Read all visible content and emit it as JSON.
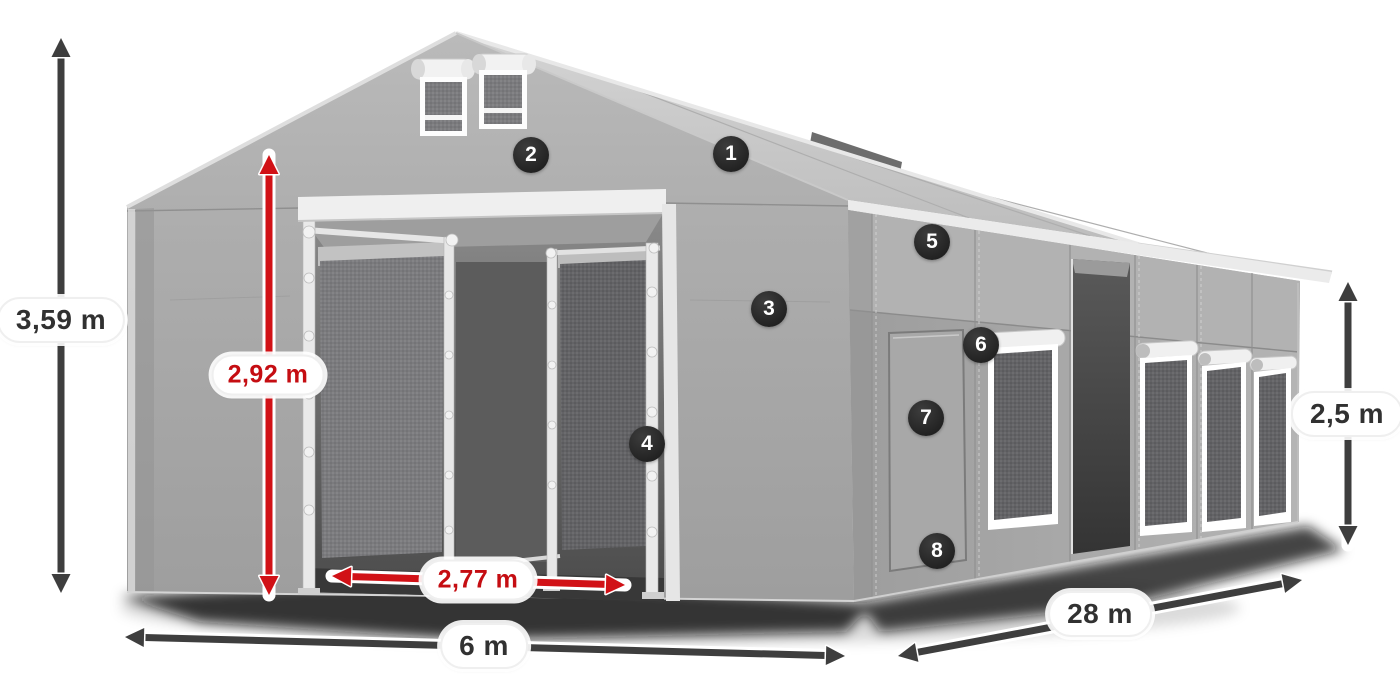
{
  "diagram": {
    "name": "tent-hall-dimensions-diagram",
    "background": "#ffffff"
  },
  "style": {
    "arrow_dark": "#3e3e3e",
    "arrow_red": "#d11116",
    "arrow_casing": "#ffffff",
    "marker_bg": "#2a2a2a",
    "marker_text": "#ffffff",
    "label_bg": "#ffffff",
    "label_border": "#efefef",
    "label_text_dark": "#313131",
    "label_text_red": "#c50d12",
    "tent_roof": "#c9c9c9",
    "tent_front": "#a9a9a9",
    "tent_side": "#a3a3a3",
    "tent_trim": "#ebebeb",
    "interior_dark": "#4f4f4f"
  },
  "markers": [
    {
      "number": "1",
      "x": 731,
      "y": 154
    },
    {
      "number": "2",
      "x": 531,
      "y": 155
    },
    {
      "number": "3",
      "x": 769,
      "y": 309
    },
    {
      "number": "4",
      "x": 647,
      "y": 444
    },
    {
      "number": "5",
      "x": 932,
      "y": 242
    },
    {
      "number": "6",
      "x": 981,
      "y": 345
    },
    {
      "number": "7",
      "x": 926,
      "y": 418
    },
    {
      "number": "8",
      "x": 937,
      "y": 551
    }
  ],
  "dimensions": [
    {
      "id": "total-height",
      "label": "3,59 m",
      "color": "dark",
      "x1": 61,
      "y1": 593,
      "x2": 61,
      "y2": 38,
      "label_x": 61,
      "label_y": 320
    },
    {
      "id": "entrance-height",
      "label": "2,92 m",
      "color": "red",
      "x1": 269,
      "y1": 595,
      "x2": 269,
      "y2": 155,
      "label_x": 268,
      "label_y": 375
    },
    {
      "id": "entrance-width",
      "label": "2,77 m",
      "color": "red",
      "x1": 332,
      "y1": 576,
      "x2": 625,
      "y2": 585,
      "label_x": 478,
      "label_y": 580
    },
    {
      "id": "front-width",
      "label": "6 m",
      "color": "dark",
      "x1": 125,
      "y1": 637,
      "x2": 845,
      "y2": 656,
      "label_x": 484,
      "label_y": 646
    },
    {
      "id": "side-length",
      "label": "28 m",
      "color": "dark",
      "x1": 898,
      "y1": 656,
      "x2": 1302,
      "y2": 580,
      "label_x": 1100,
      "label_y": 614
    },
    {
      "id": "side-height",
      "label": "2,5 m",
      "color": "dark",
      "x1": 1348,
      "y1": 545,
      "x2": 1348,
      "y2": 282,
      "label_x": 1347,
      "label_y": 414
    }
  ]
}
